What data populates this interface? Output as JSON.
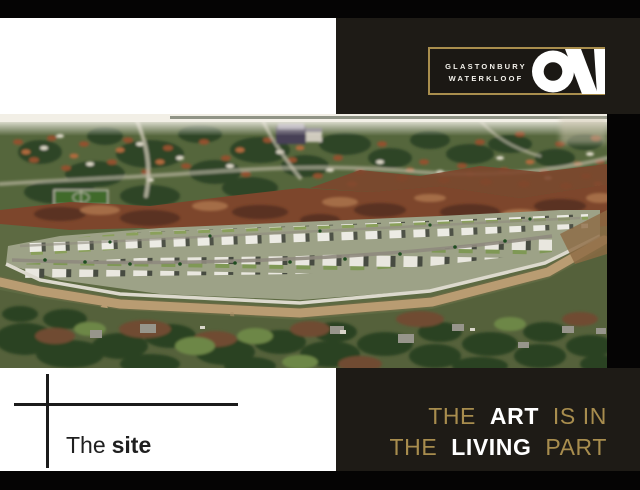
{
  "slide": {
    "colors": {
      "background": "#050404",
      "card": "#ffffff",
      "panel": "#1e1b16",
      "logo_border_gold": "#a98e4d",
      "headline_gold": "#a88d4e",
      "headline_white": "#ffffff",
      "caption_text": "#1f1f1f"
    },
    "logo": {
      "name_line1": "GLASTONBURY",
      "name_line2": "WATERKLOOF",
      "monogram": "ON"
    },
    "headline": {
      "line1": {
        "w1": "THE",
        "w2": "ART",
        "w3": "IS IN"
      },
      "line2": {
        "w1": "THE",
        "w2": "LIVING",
        "w3": "PART"
      }
    },
    "caption": {
      "regular": "The",
      "bold": "site"
    },
    "photo": {
      "description": "Aerial drone view of the development site: a walled estate of modern white houses with lawns and internal roads, surrounded by tree-filled suburbs with terracotta roofs, swaths of cleared red earth, and a tan perimeter road through green bushveld."
    }
  }
}
